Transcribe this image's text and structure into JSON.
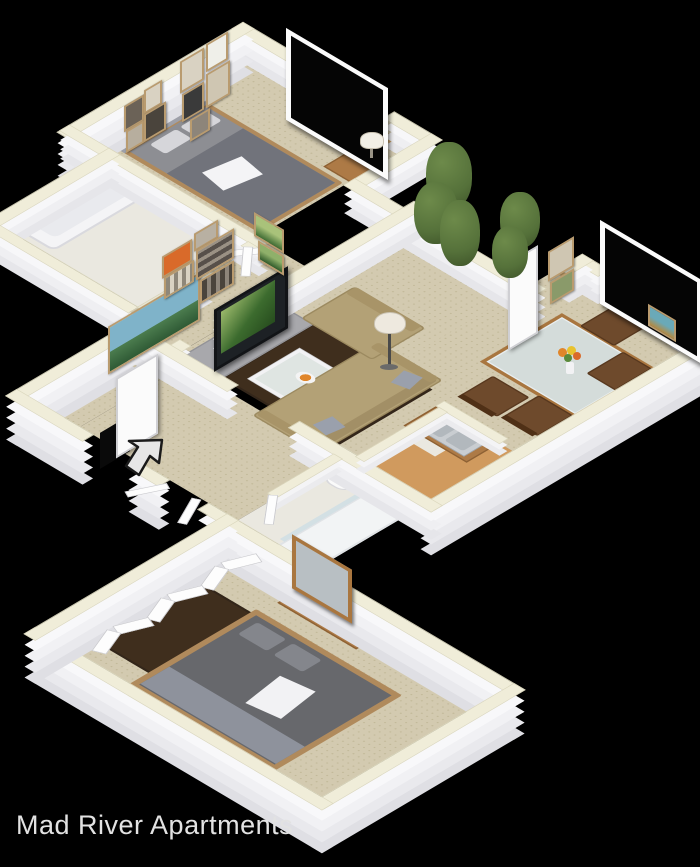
{
  "title": {
    "text": "Mad River Apartments"
  },
  "palette": {
    "background": "#000000",
    "wall_cap": "#f0edd9",
    "carpet": "#d3cab0",
    "wood_floor": "#d09a5e",
    "tile": "#eae8e0",
    "rug": "#3f2e1d",
    "sofa": "#b3a176",
    "wood_furniture": "#ad7a46",
    "bed_gray": "#8d8e93",
    "bed_dark": "#67686c",
    "steel": "#c9cdd1",
    "glass": "#cfdee4",
    "tree": "#55713a",
    "tv": "#1d2125",
    "title_color": "#e2e2e2"
  },
  "floorplan": {
    "type": "3d-isometric-floor-plan",
    "style": "two-bedroom apartment, white walls with cream wall caps, beige carpet",
    "rooms": [
      {
        "name": "bedroom-1",
        "furniture": [
          "bed",
          "nightstand",
          "table-lamp",
          "gallery-frames",
          "window"
        ]
      },
      {
        "name": "bathroom-1",
        "furniture": [
          "bathtub",
          "vanity",
          "toilet",
          "door"
        ]
      },
      {
        "name": "hallway",
        "furniture": [
          "door"
        ]
      },
      {
        "name": "living-room",
        "furniture": [
          "tv",
          "tv-console",
          "sofa",
          "armchair",
          "coffee-table",
          "area-rug",
          "floor-lamp",
          "landscape-gallery"
        ]
      },
      {
        "name": "dining-area",
        "furniture": [
          "glass-dining-table",
          "dining-chairs",
          "flower-vase",
          "window",
          "wall-frames",
          "patio-door"
        ]
      },
      {
        "name": "kitchen",
        "furniture": [
          "counter",
          "double-steel-sink",
          "wood-floor"
        ]
      },
      {
        "name": "entry",
        "furniture": [
          "entry-door",
          "entry-arrow"
        ]
      },
      {
        "name": "bathroom-2",
        "furniture": [
          "toilet",
          "shower"
        ]
      },
      {
        "name": "bedroom-2",
        "furniture": [
          "bed",
          "dresser",
          "wall-mirror",
          "closet-bifold-doors",
          "area-rug"
        ]
      }
    ],
    "outdoor": [
      "trees"
    ]
  },
  "icons": [
    {
      "name": "entry-arrow-icon",
      "meaning": "unit entrance direction"
    }
  ]
}
